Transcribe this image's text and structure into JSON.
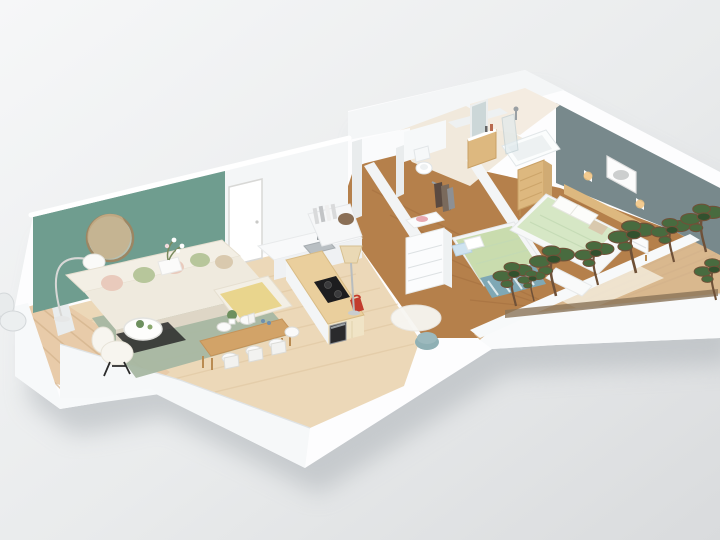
{
  "scene": {
    "type": "isometric-3d-apartment-floorplan-render",
    "rooms_visible": [
      "living-room",
      "dining-area",
      "kitchen",
      "hallway",
      "wc",
      "bathroom",
      "small-bedroom",
      "master-bedroom",
      "balcony",
      "terrace"
    ]
  },
  "colors": {
    "bg_top": "#f6f7f8",
    "bg_bottom": "#d9dbdd",
    "shadow": "#a6acb1",
    "wall_white": "#fdfdfe",
    "wall_light": "#f4f6f7",
    "wall_mid": "#e9eced",
    "accent_green_wall": "#6f9d8f",
    "accent_gray_wall": "#78898c",
    "floor_living": "#ecd8b8",
    "floor_wood_dark": "#b5804b",
    "floor_bath": "#f1e9dc",
    "deck_terrace": "#d9b88e",
    "deck_balcony": "#e8cba9",
    "rug_sage": "#a7b7a2",
    "rug_blue": "#7fa8b5",
    "rug_white": "#f7f6f2",
    "sofa_cream": "#f3efe5",
    "sofa_shadow": "#ded6c6",
    "pillow_pink": "#e9cabc",
    "pillow_green": "#b7c69b",
    "pillow_beige": "#d9c9ae",
    "pillow_blue": "#cfe3f0",
    "throw_yellow": "#e9d58d",
    "duvet_green": "#c9dcae",
    "duvet_mint": "#d6e7c5",
    "wood_oak": "#d2a368",
    "counter_wood": "#eacf9d",
    "wood_furniture": "#ddb87f",
    "tree_green": "#486b3f",
    "tree_green_dark": "#32512e",
    "trunk_brown": "#6f5138",
    "pouf_teal": "#8fb0b4",
    "kettle_red": "#c23b2d",
    "cooktop_black": "#1d1d1f",
    "clothes_dark": "#5a4a41",
    "mirror_frame": "#9c8663",
    "glass_blue": "#dfe9ec",
    "sconce_glow": "#f1c27d",
    "art_gray": "#c7c9c9"
  }
}
